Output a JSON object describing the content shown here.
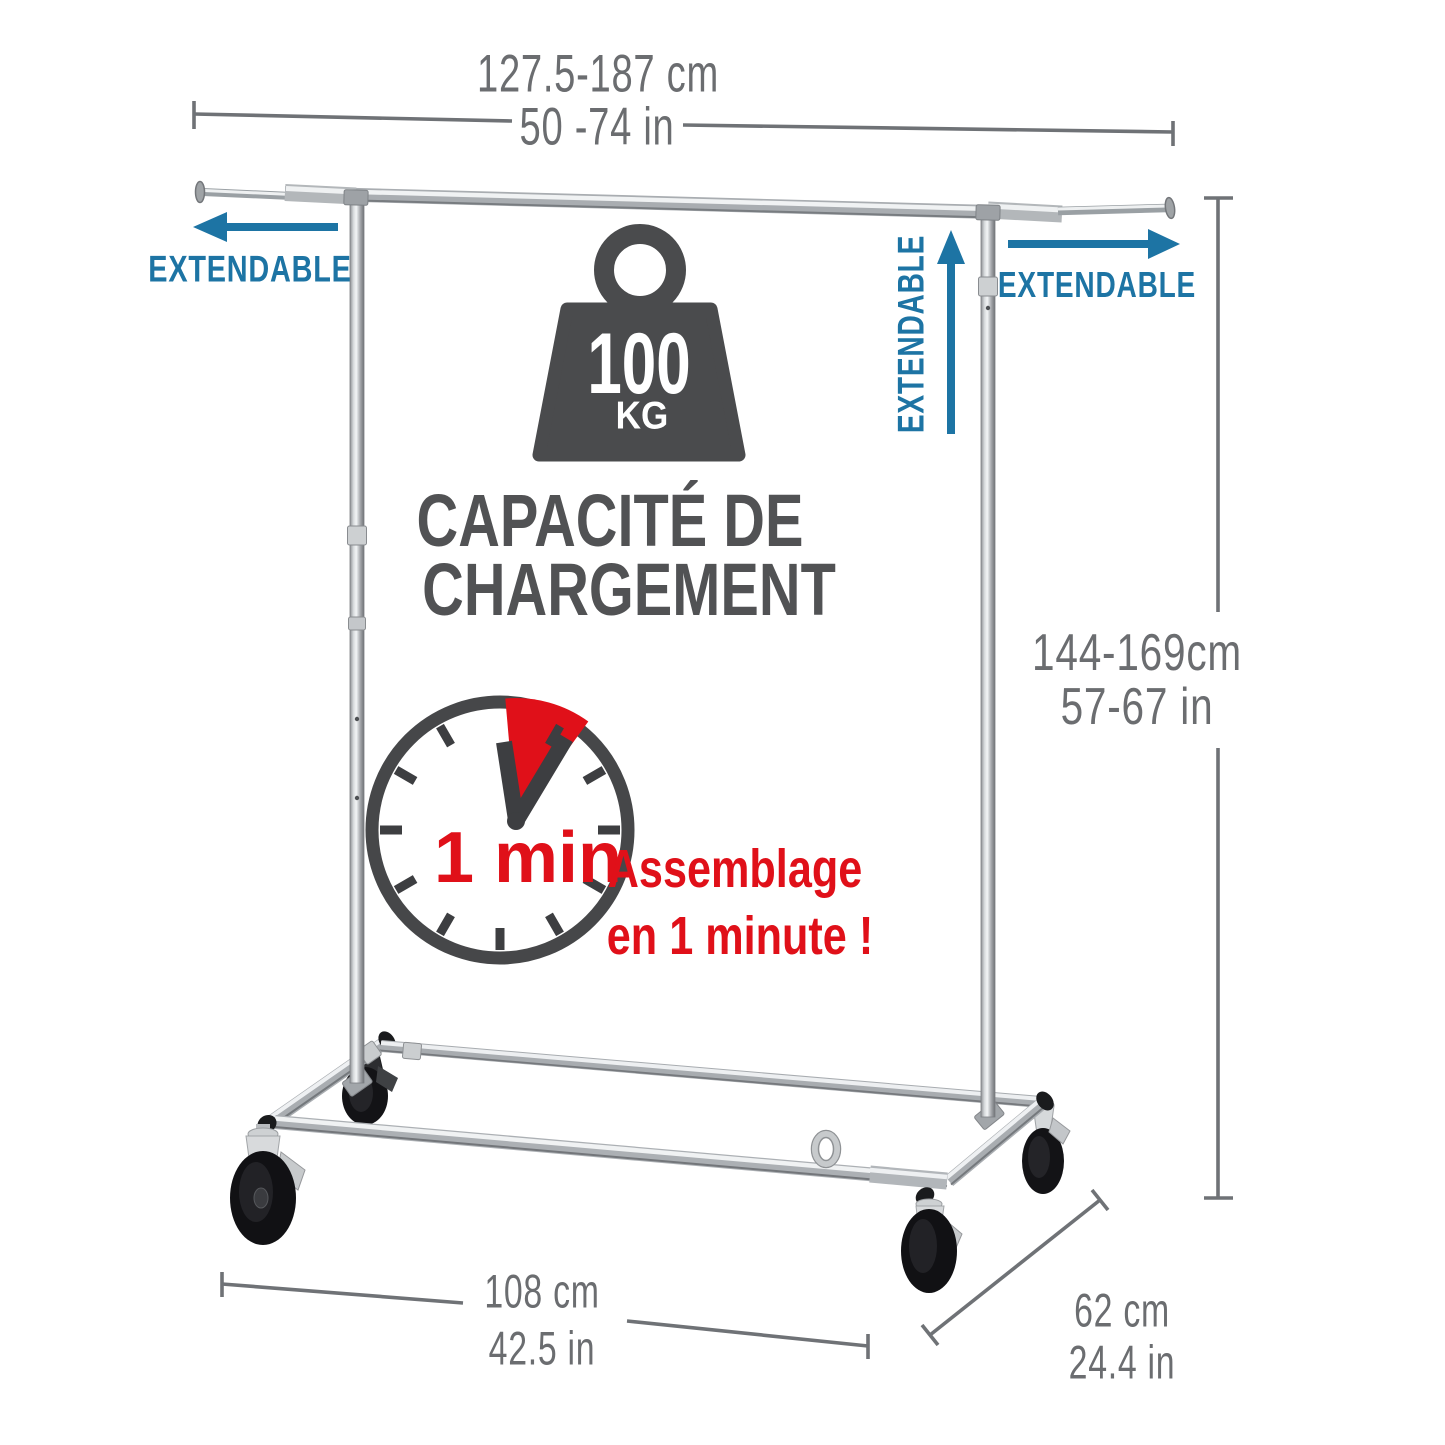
{
  "title": "Extendable clothes rack infographic",
  "colors": {
    "accent_blue": "#1d74a4",
    "accent_red": "#e01019",
    "icon_dark_gray": "#4a4b4d",
    "dimension_gray": "#6b6d70"
  },
  "dimensions": {
    "top_width": {
      "cm": "127.5-187 cm",
      "inches": "50 -74 in"
    },
    "right_height": {
      "cm": "144-169cm",
      "inches": "57-67 in"
    },
    "bottom_length": {
      "cm": "108 cm",
      "inches": "42.5 in"
    },
    "side_depth": {
      "cm": "62 cm",
      "inches": "24.4 in"
    }
  },
  "extendable": {
    "left": "EXTENDABLE",
    "middle": "EXTENDABLE",
    "right": "EXTENDABLE"
  },
  "load_capacity": {
    "weight_value": "100",
    "weight_unit": "KG",
    "caption_line1": "CAPACITÉ DE",
    "caption_line2": "CHARGEMENT"
  },
  "assembly": {
    "clock_label": "1 min",
    "caption_line1": "Assemblage",
    "caption_line2": "en 1 minute !"
  }
}
